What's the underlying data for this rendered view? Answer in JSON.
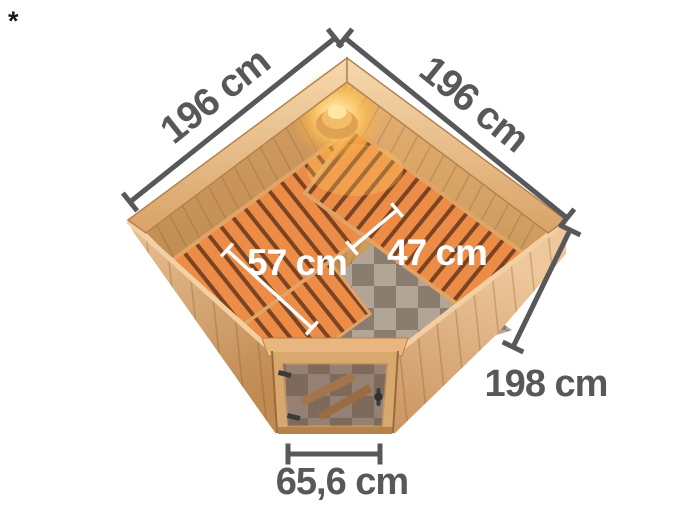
{
  "page": {
    "background_color": "#ffffff",
    "footnote_marker": "*"
  },
  "diagram": {
    "subject": "corner-sauna-top-view",
    "annotations": {
      "width_back_left": {
        "label": "196 cm",
        "orientation": "diagonal-left"
      },
      "width_back_right": {
        "label": "196 cm",
        "orientation": "diagonal-right"
      },
      "bench_depth_large": {
        "label": "57 cm",
        "orientation": "interior-white"
      },
      "bench_depth_small": {
        "label": "47 cm",
        "orientation": "interior-white"
      },
      "exterior_height": {
        "label": "198 cm",
        "orientation": "horizontal"
      },
      "door_width": {
        "label": "65,6 cm",
        "orientation": "horizontal"
      }
    },
    "colors": {
      "dimension_line": "#58585a",
      "dimension_text": "#58585a",
      "interior_dimension_line": "#ffffff",
      "interior_dimension_text": "#ffffff",
      "wood_rim_light": "#f4d5a8",
      "wood_rim_dark": "#d9a267",
      "wood_wall_exterior": "#e0b080",
      "wood_wall_interior": "#c99257",
      "bench_slat": "#ec8c46",
      "bench_gap": "#7a4423",
      "bench_frame": "#e2a466",
      "floor_tile_light": "#b2a596",
      "floor_tile_dark": "#8a7d6f",
      "door_glass_tint": "#6e5246",
      "hardware_dark": "#3a3a3a",
      "lamp_glow": "#ffcf6a"
    }
  }
}
